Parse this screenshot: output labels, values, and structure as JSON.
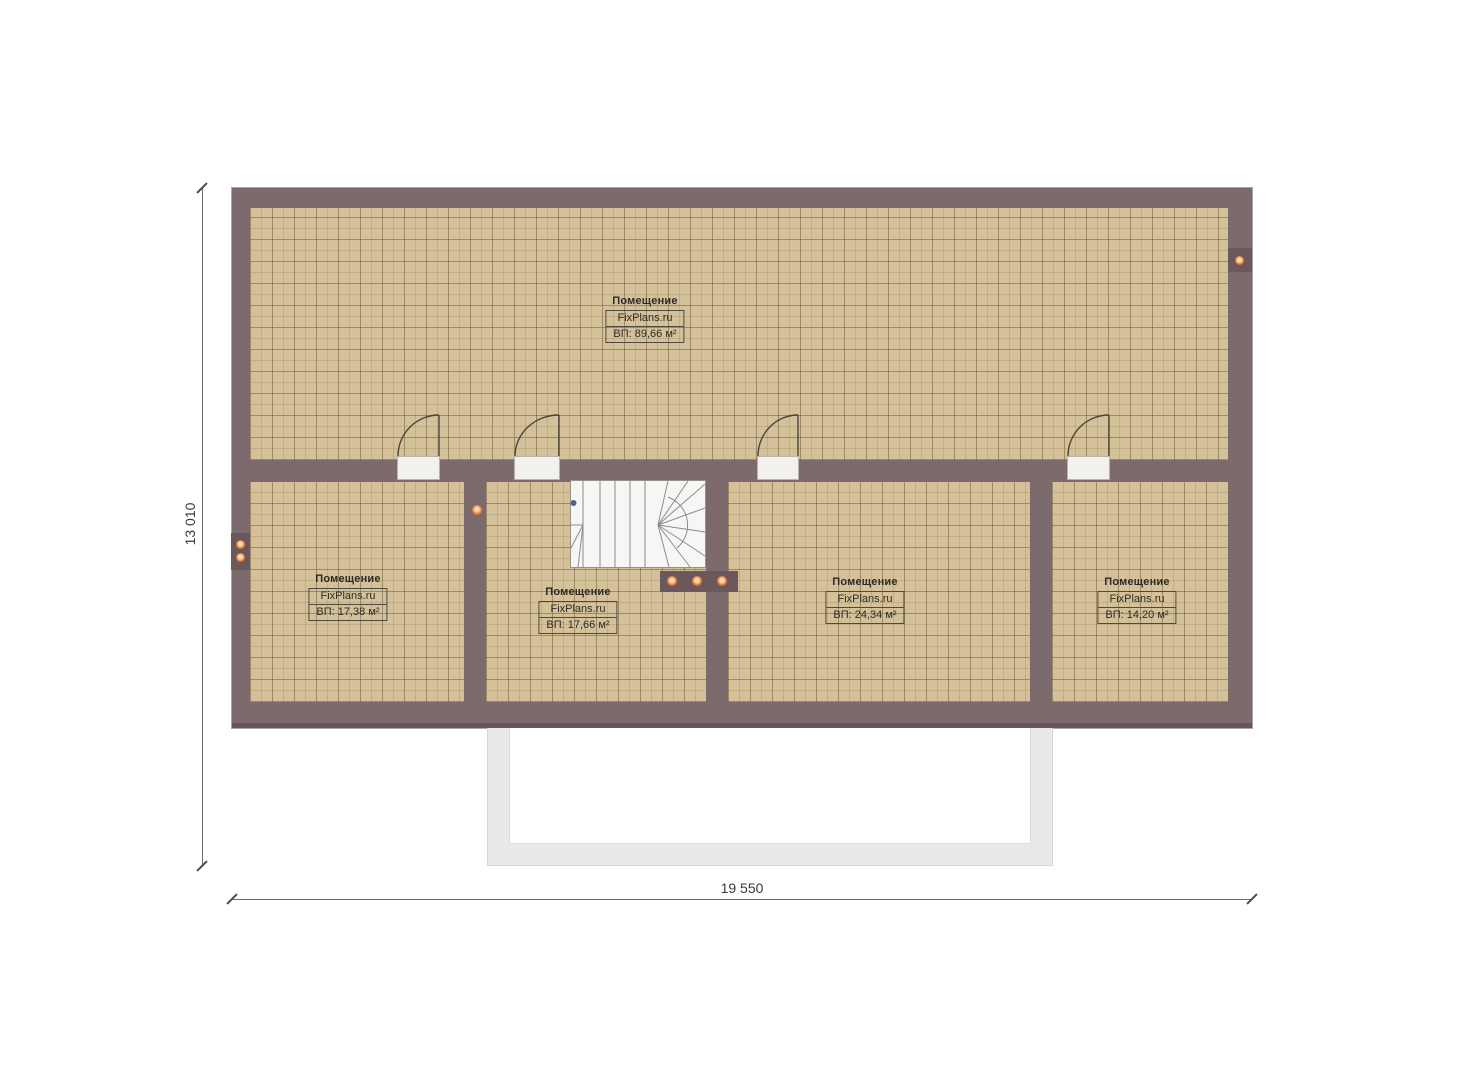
{
  "title": "floor-plan",
  "dimensions": {
    "width_label": "19 550",
    "height_label": "13 010"
  },
  "rooms": [
    {
      "id": "room-top",
      "name": "Помещение",
      "brand": "FixPlans.ru",
      "area": "ВП: 89,66 м²"
    },
    {
      "id": "room-bottom-1",
      "name": "Помещение",
      "brand": "FixPlans.ru",
      "area": "ВП: 17,38 м²"
    },
    {
      "id": "room-bottom-2",
      "name": "Помещение",
      "brand": "FixPlans.ru",
      "area": "ВП: 17,66 м²"
    },
    {
      "id": "room-bottom-3",
      "name": "Помещение",
      "brand": "FixPlans.ru",
      "area": "ВП: 24,34 м²"
    },
    {
      "id": "room-bottom-4",
      "name": "Помещение",
      "brand": "FixPlans.ru",
      "area": "ВП: 14,20 м²"
    }
  ],
  "fixtures": {
    "stair_spotlights_count": 3,
    "left_wall_spotlights_count": 2,
    "right_wall_spotlights_count": 1,
    "partition_spotlights_count": 1
  },
  "colors": {
    "wall": "#7c6a6c",
    "wall_dark": "#675659",
    "panel": "#6b585c",
    "floor": "#d4c199",
    "door_sill": "#f2f1ee",
    "stair_bg": "#f6f6f4",
    "porch_band": "#e9e9e9",
    "accent_dot": "#e8813f",
    "dim_text": "#3a3a3a"
  }
}
